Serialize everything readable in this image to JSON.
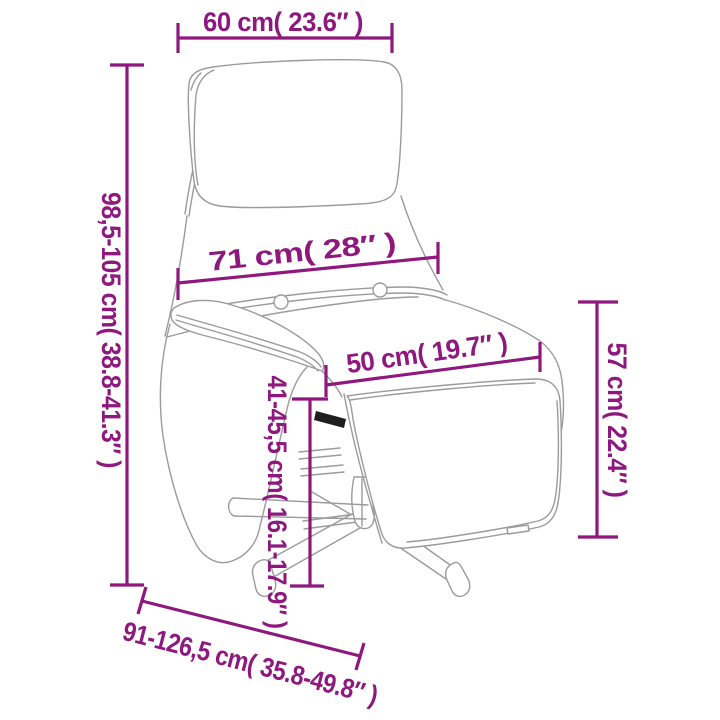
{
  "diagram": {
    "title": "recliner-chair-dimension-diagram",
    "colors": {
      "dimension_accent": "#8E187E",
      "artwork_line": "#9B9B9B",
      "background": "#FFFFFF"
    },
    "dimensions": {
      "headrest_width": "60 cm( 23.6″ )",
      "overall_height": "98,5-105 cm( 38.8-41.3″ )",
      "backrest_width": "71 cm( 28″ )",
      "seat_width": "50 cm( 19.7″ )",
      "footrest_height": "57 cm( 22.4″ )",
      "seat_height": "41-45,5 cm( 16.1-17.9″ )",
      "overall_depth": "91-126,5 cm( 35.8-49.8″ )"
    }
  }
}
